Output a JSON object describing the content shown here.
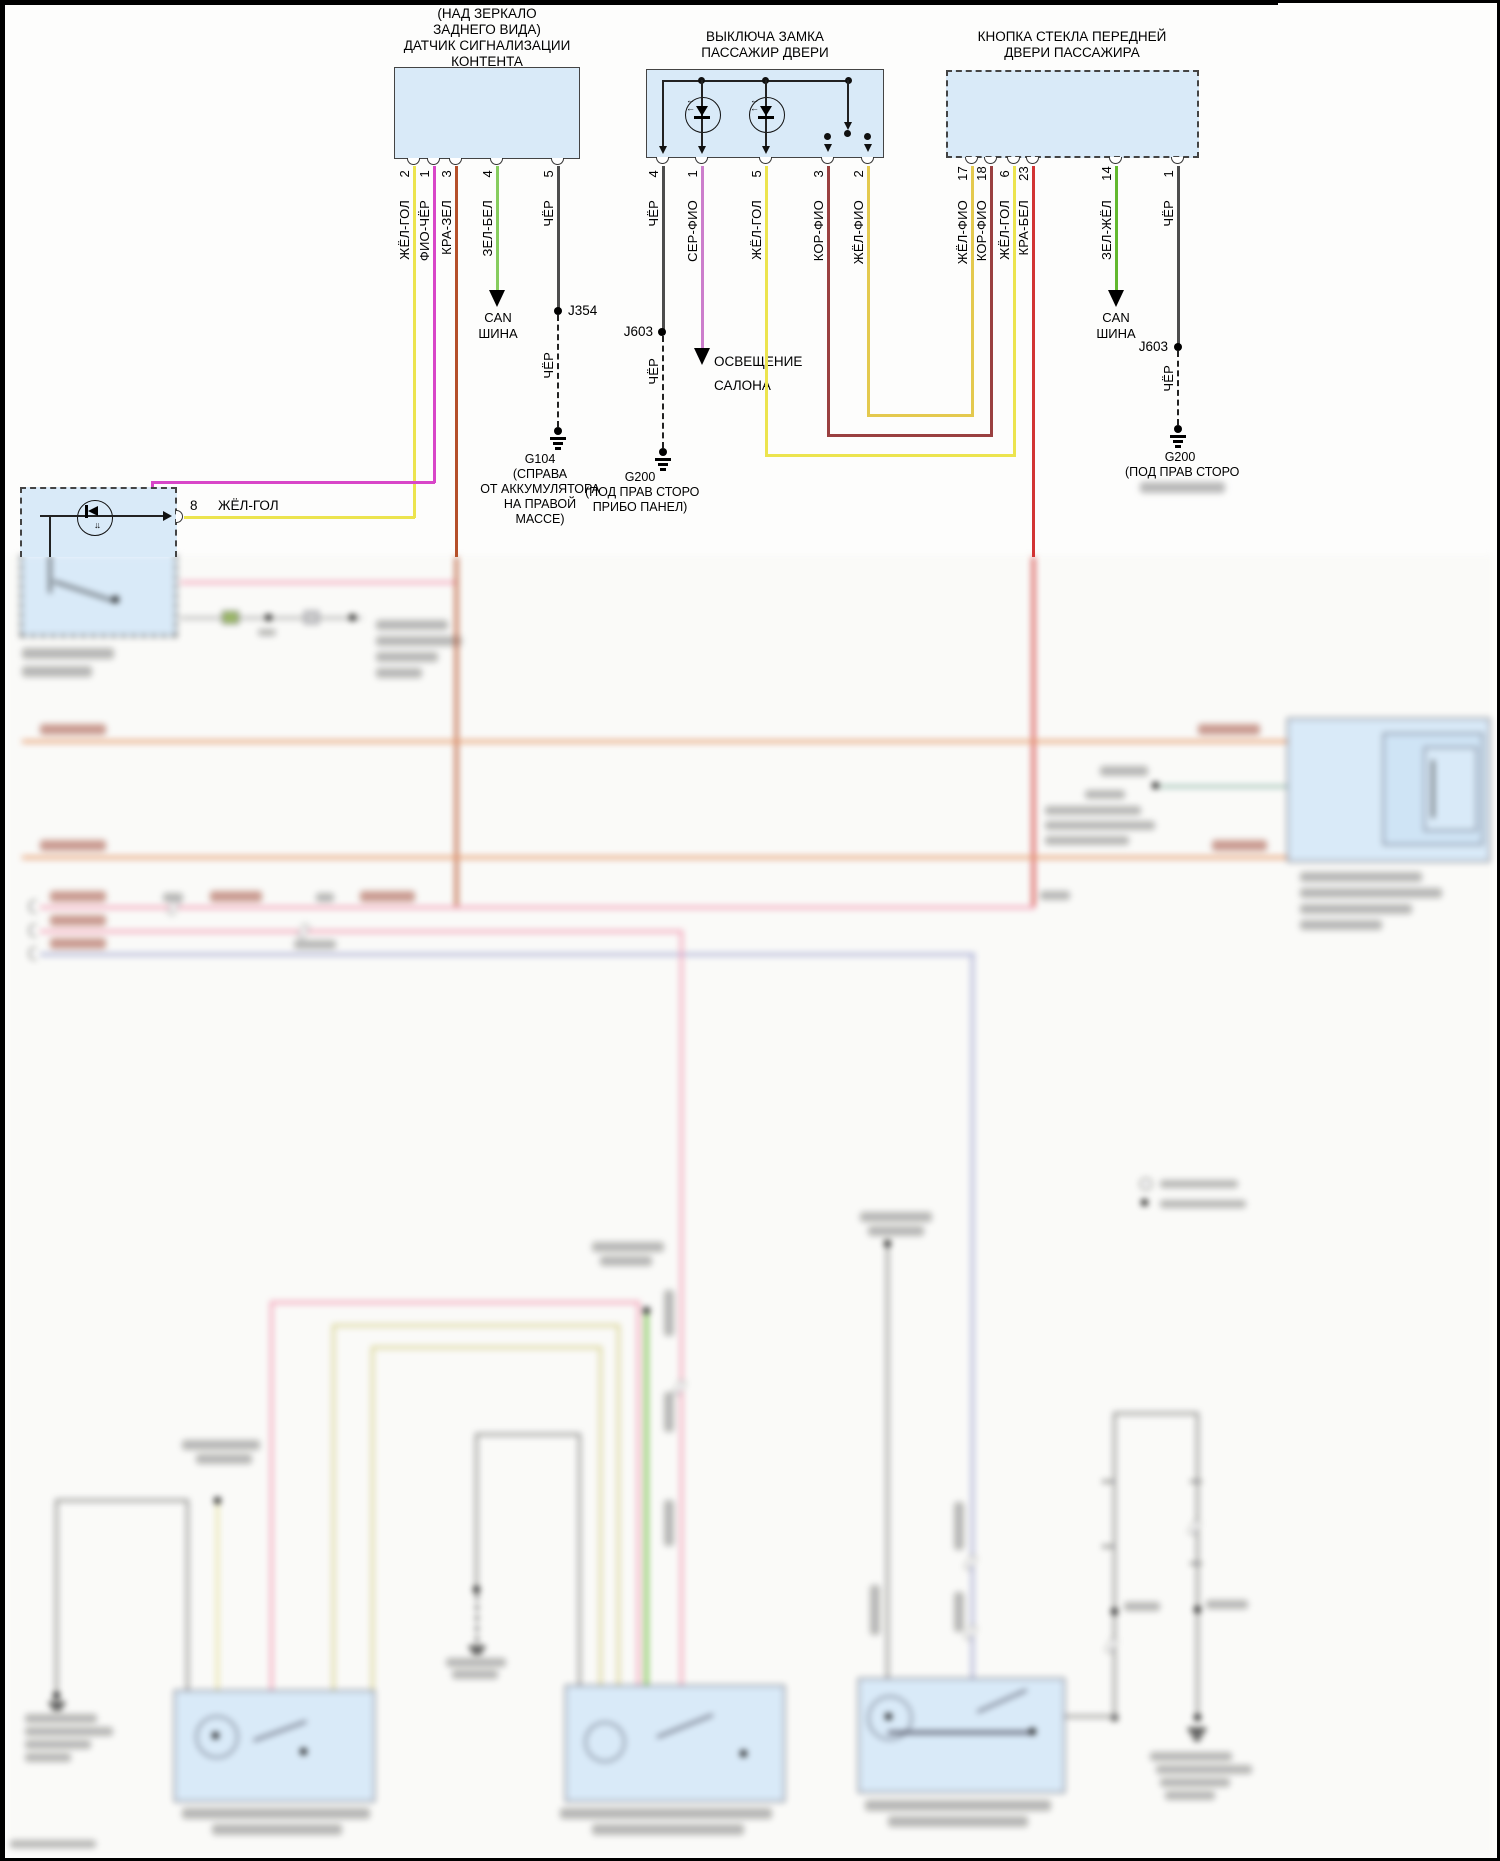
{
  "sensor": {
    "title": [
      "(НАД ЗЕРКАЛО",
      "ЗАДНЕГО ВИДА)",
      "ДАТЧИК СИГНАЛИЗАЦИИ",
      "КОНТЕНТА"
    ],
    "pins": [
      {
        "num": "2",
        "color_label": "ЖЁЛ-ГОЛ"
      },
      {
        "num": "1",
        "color_label": "ФИО-ЧЁР"
      },
      {
        "num": "3",
        "color_label": "КРА-ЗЕЛ"
      },
      {
        "num": "4",
        "color_label": "ЗЕЛ-БЕЛ"
      },
      {
        "num": "5",
        "color_label": "ЧЁР"
      }
    ]
  },
  "lock_switch": {
    "title": [
      "ВЫКЛЮЧА ЗАМКА",
      "ПАССАЖИР ДВЕРИ"
    ],
    "pins": [
      {
        "num": "4",
        "color_label": "ЧЁР"
      },
      {
        "num": "1",
        "color_label": "СЕР-ФИО"
      },
      {
        "num": "5",
        "color_label": "ЖЁЛ-ГОЛ"
      },
      {
        "num": "3",
        "color_label": "КОР-ФИО"
      },
      {
        "num": "2",
        "color_label": "ЖЁЛ-ФИО"
      }
    ]
  },
  "window_button": {
    "title": [
      "КНОПКА СТЕКЛА ПЕРЕДНЕЙ",
      "ДВЕРИ ПАССАЖИРА"
    ],
    "pins": [
      {
        "num": "17",
        "color_label": "ЖЁЛ-ФИО"
      },
      {
        "num": "18",
        "color_label": "КОР-ФИО"
      },
      {
        "num": "6",
        "color_label": "ЖЁЛ-ГОЛ"
      },
      {
        "num": "23",
        "color_label": "КРА-БЕЛ"
      },
      {
        "num": "14",
        "color_label": "ЗЕЛ-ЖЁЛ"
      },
      {
        "num": "1",
        "color_label": "ЧЁР"
      }
    ]
  },
  "mirror_module": {
    "pin_num": "8",
    "pin_color_label": "ЖЁЛ-ГОЛ"
  },
  "labels": {
    "can_bus": [
      "CAN",
      "ШИНА"
    ],
    "cabin_light": [
      "ОСВЕЩЕНИЕ",
      "САЛОНА"
    ],
    "j354": "J354",
    "j603": "J603",
    "cher": "ЧЁР",
    "g104": {
      "name": "G104",
      "desc": [
        "(СПРАВА",
        "ОТ АККУМУЛЯТОРА",
        "НА ПРАВОЙ",
        "МАССЕ)"
      ]
    },
    "g200_mid": {
      "name": "G200",
      "desc": [
        "(ПОД ПРАВ СТОРО",
        "ПРИБО ПАНЕЛ)"
      ]
    },
    "g200_right": {
      "name": "G200",
      "desc": [
        "(ПОД ПРАВ СТОРО"
      ]
    }
  },
  "colors": {
    "box_fill": "#d9eaf8",
    "yellow": "#ece44e",
    "magenta": "#d846c8",
    "brick": "#b5502a",
    "light_green": "#86cc5e",
    "black_wire": "#4d4d4d",
    "orchid": "#cc7ecc",
    "maroon": "#9a4040",
    "yellow_orange": "#e4c94e",
    "red": "#d23434",
    "green": "#62b82e",
    "orange": "#e59a6e",
    "pink": "#f2a3bb",
    "lavender": "#a9aed6",
    "khaki": "#d9d49b",
    "gray_wire": "#9a9a9a",
    "teal": "#9cbfb4"
  }
}
